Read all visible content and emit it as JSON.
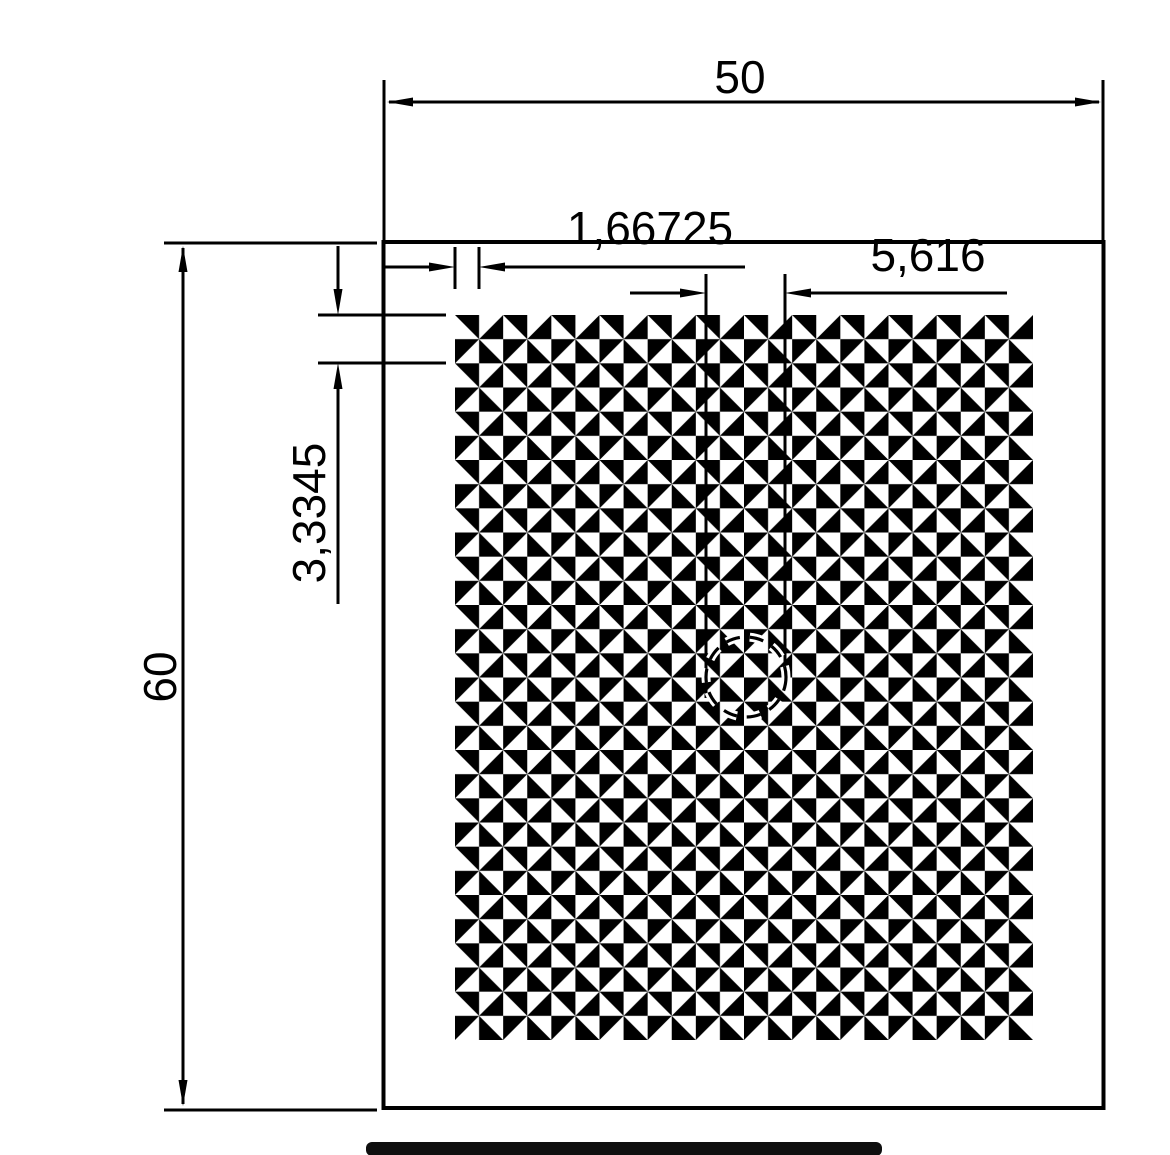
{
  "drawing": {
    "labels": {
      "overall_width": "50",
      "overall_height": "60",
      "cell_pitch": "1,66725",
      "detail_diameter": "5,616",
      "double_row_pitch": "3,3345"
    },
    "colors": {
      "ink": "#000000",
      "background": "#ffffff",
      "bottom_bar": "#0f0f0f"
    }
  }
}
